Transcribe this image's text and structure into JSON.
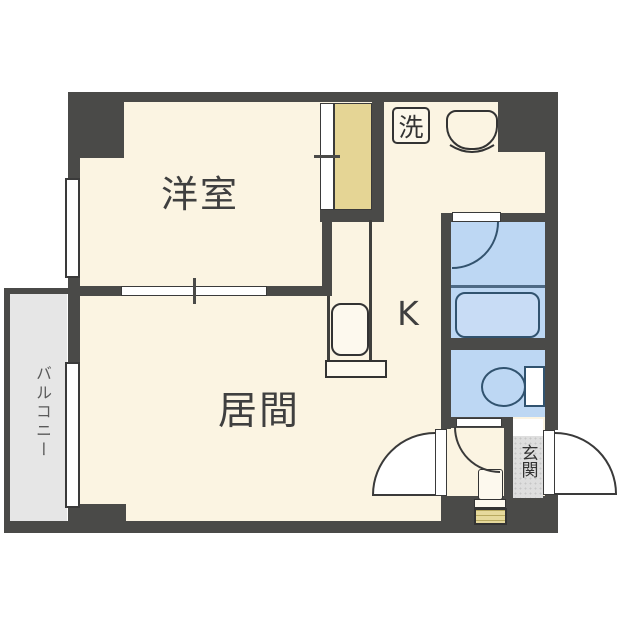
{
  "plan_title": "apartment-floor-plan",
  "labels": {
    "western_room": "洋室",
    "living_room": "居間",
    "kitchen": "K",
    "washer": "洗",
    "entrance": "玄関",
    "balcony": "バルコニー"
  },
  "colors": {
    "wall": "#4a4a48",
    "floor": "#fbf4e2",
    "closet": "#e5d595",
    "water_blue": "#bdd7f3",
    "fixture_outline": "#31536f",
    "balcony": "#e6e6e6",
    "entrance_tile": "#dedede",
    "mat": "#e6d99c",
    "label_text": "#3f3f3f"
  }
}
